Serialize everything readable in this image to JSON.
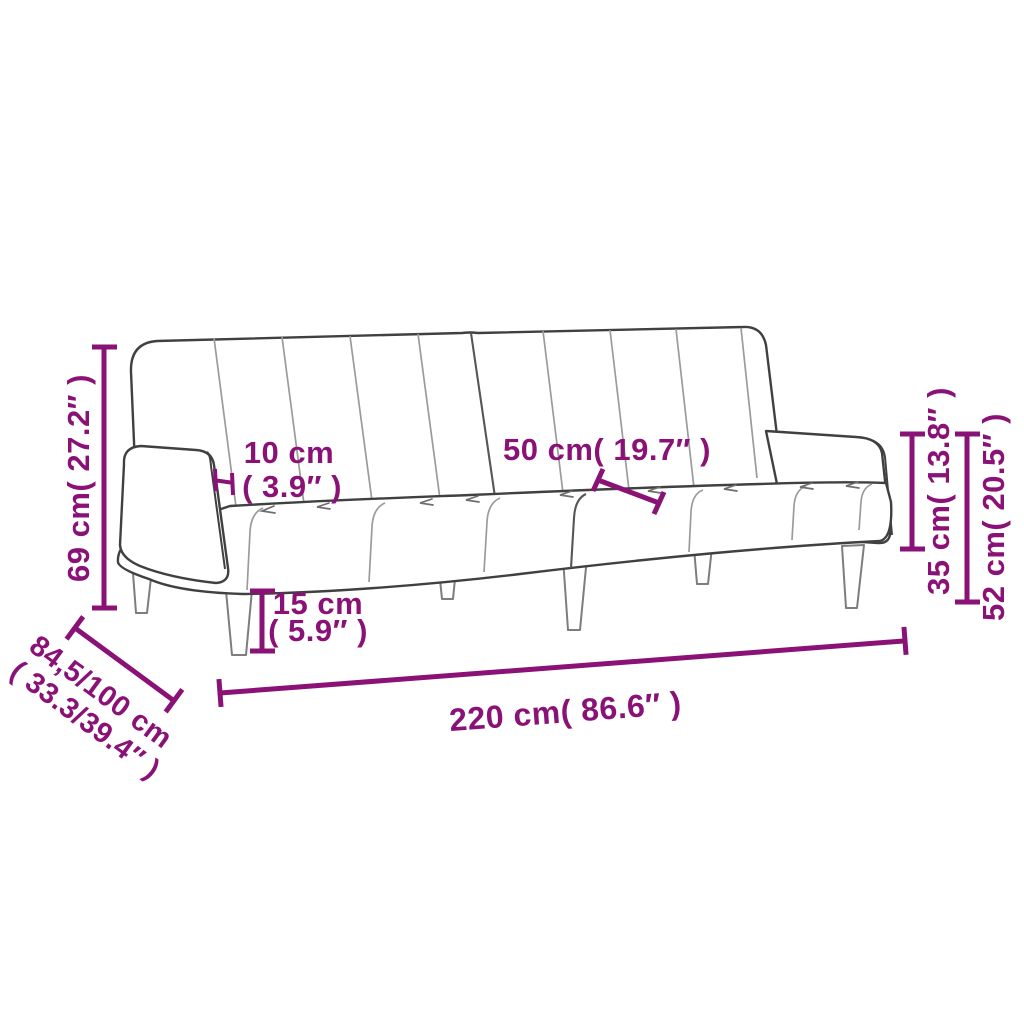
{
  "diagram": {
    "kind": "product-dimension-diagram",
    "subject": "two-seater-sofa-bed-line-art",
    "accent_color": "#8a1277",
    "outline_color": "#404040",
    "background_color": "#ffffff"
  },
  "dimensions": {
    "overall_height": {
      "label": "69 cm( 27.2″ )"
    },
    "armrest_width": {
      "line1": "10 cm",
      "line2": "( 3.9″ )"
    },
    "seat_depth": {
      "label": "50 cm( 19.7″ )"
    },
    "leg_height": {
      "line1": "15 cm",
      "line2": "( 5.9″ )"
    },
    "seat_height": {
      "label": "35 cm( 13.8″ )"
    },
    "armrest_height": {
      "label": "52 cm( 20.5″ )"
    },
    "overall_width": {
      "label": "220 cm( 86.6″ )"
    },
    "overall_depth": {
      "line1": "84,5/100 cm",
      "line2": "( 33.3/39.4″ )"
    }
  }
}
